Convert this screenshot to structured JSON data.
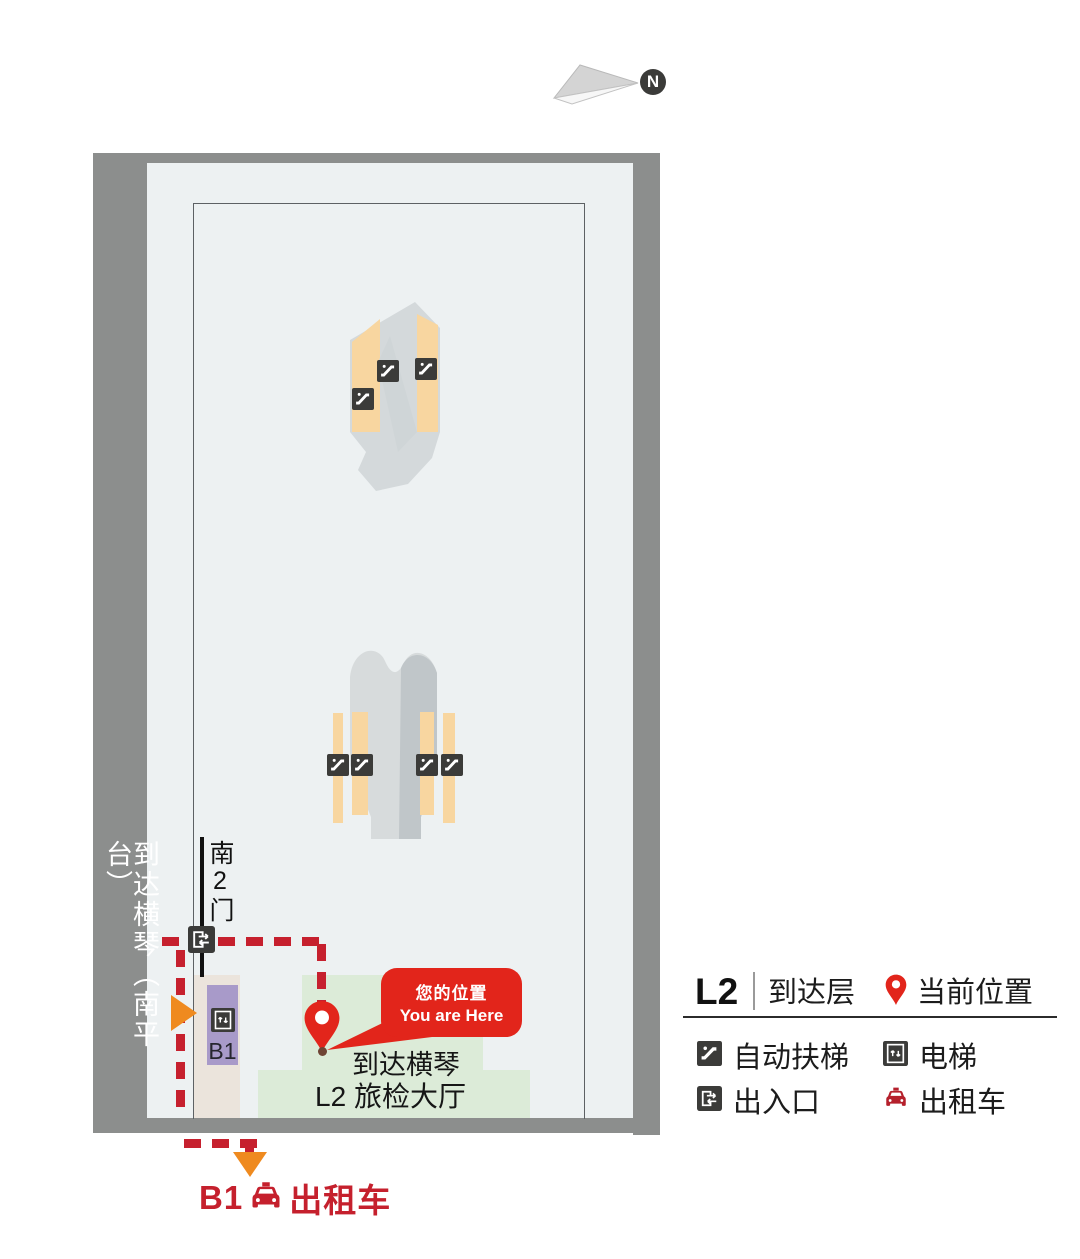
{
  "north_indicator": {
    "label": "N"
  },
  "map": {
    "platform_label": "到达横琴（南平台）",
    "gate_label": "南2门",
    "elevator_floor_label": "B1",
    "you_are_here": {
      "cn": "您的位置",
      "en": "You are Here"
    },
    "hall_label": {
      "line1": "到达横琴",
      "line2": "L2 旅检大厅"
    },
    "taxi_callout": {
      "floor": "B1",
      "label": "出租车"
    }
  },
  "legend": {
    "floor": "L2",
    "floor_name": "到达层",
    "current_location": "当前位置",
    "items": [
      {
        "icon": "escalator-icon",
        "label": "自动扶梯"
      },
      {
        "icon": "elevator-icon",
        "label": "电梯"
      },
      {
        "icon": "entrance-exit-icon",
        "label": "出入口"
      },
      {
        "icon": "taxi-icon",
        "label": "出租车"
      }
    ]
  },
  "colors": {
    "frame_gray": "#8c8e8d",
    "floor": "#edf1f2",
    "route_red": "#c6202e",
    "highlight_red": "#e2251b",
    "purple": "#a89ac9",
    "green": "#dcebd8",
    "beige": "#ebe4dc",
    "orange_stripe": "#f8d6a0",
    "orange_arrow": "#ef8a1f",
    "icon_dark": "#3b3b39"
  }
}
